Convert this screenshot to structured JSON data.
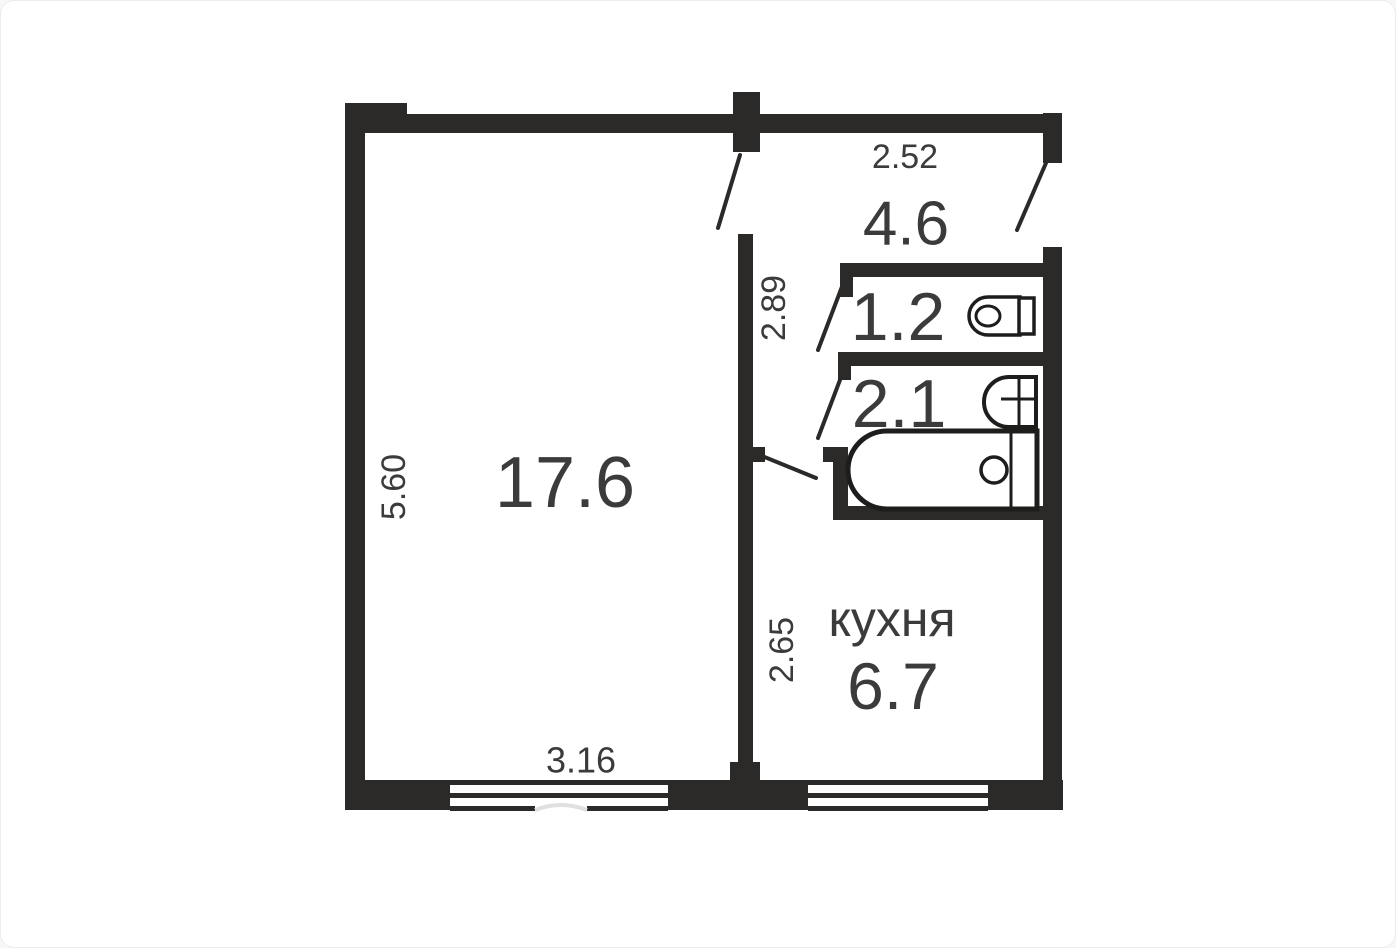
{
  "plan": {
    "type": "apartment-floor-plan",
    "rooms": {
      "living": {
        "area": "17.6"
      },
      "hall": {
        "area": "4.6"
      },
      "wc": {
        "area": "1.2"
      },
      "bath": {
        "area": "2.1"
      },
      "kitchen": {
        "name": "кухня",
        "area": "6.7"
      }
    },
    "dims": {
      "hall_width": "2.52",
      "hall_depth": "2.89",
      "living_depth": "5.60",
      "living_width": "3.16",
      "kitchen_depth": "2.65"
    },
    "icons": [
      "toilet-icon",
      "sink-icon",
      "bathtub-icon",
      "window-icon",
      "door-swing-icon"
    ],
    "colors": {
      "wall": "#2b2a29",
      "text": "#3b3b3b",
      "background": "#ffffff",
      "fixture_stroke": "#1d1d1b"
    }
  }
}
